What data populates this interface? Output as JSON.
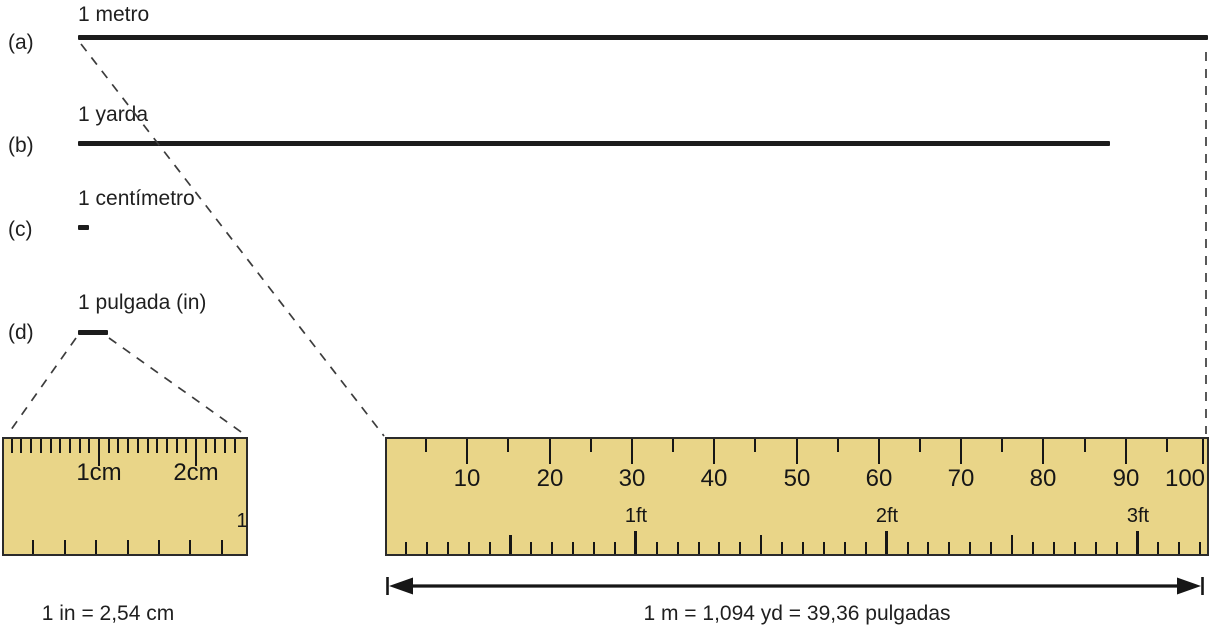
{
  "figure_title": "Comparación de unidades de longitud",
  "colors": {
    "ruler_fill": "#e9d588",
    "ruler_border": "#2b2b2b",
    "bar": "#1c1c1c",
    "tick": "#161616",
    "dash": "#3c3c3c",
    "text": "#1f1f1f"
  },
  "rows": [
    {
      "id": "a",
      "tag": "(a)",
      "name": "1 metro",
      "tag_top": 31,
      "name_top": 3,
      "bar_top": 35,
      "bar_width": 1130
    },
    {
      "id": "b",
      "tag": "(b)",
      "name": "1 yarda",
      "tag_top": 134,
      "name_top": 103,
      "bar_top": 141,
      "bar_width": 1032
    },
    {
      "id": "c",
      "tag": "(c)",
      "name": "1 centímetro",
      "tag_top": 218,
      "name_top": 187,
      "bar_top": 225,
      "bar_width": 11
    },
    {
      "id": "d",
      "tag": "(d)",
      "name": "1 pulgada (in)",
      "tag_top": 321,
      "name_top": 291,
      "bar_top": 330,
      "bar_width": 30
    }
  ],
  "small_ruler": {
    "description": "cm-vs-inch magnified ruler",
    "tick_groups": [
      {
        "name": "mm-tick",
        "side": "top",
        "length": 14,
        "width": 2,
        "positions": [
          9.7,
          19.4,
          29.1,
          38.8,
          48.5,
          58.2,
          67.9,
          77.6,
          87.3,
          106.7,
          116.4,
          126.1,
          135.8,
          145.5,
          155.2,
          164.9,
          174.6,
          184.3,
          203.7,
          213.4,
          223.1,
          232.8
        ]
      },
      {
        "name": "cm-tick",
        "side": "top",
        "length": 27,
        "width": 2.6,
        "positions": [
          97,
          194
        ]
      },
      {
        "name": "eighth-inch-tick",
        "side": "bottom",
        "length": 14,
        "width": 2,
        "positions": [
          31.4,
          62.8,
          94.2,
          125.6,
          157,
          188.4,
          219.8
        ]
      }
    ],
    "labels": [
      {
        "name": "cm-1-label",
        "text": "1cm",
        "x": 97,
        "top": 21,
        "font": 24
      },
      {
        "name": "cm-2-label",
        "text": "2cm",
        "x": 194,
        "top": 21,
        "font": 24
      },
      {
        "name": "inch-1-label",
        "text": "1",
        "x": 240,
        "top": 71,
        "font": 20
      }
    ]
  },
  "large_ruler": {
    "description": "meter stick with cm (top) and inch/ft (bottom) scales",
    "tick_groups": [
      {
        "name": "cm5-tick",
        "side": "top",
        "length": 13,
        "width": 2.2,
        "positions": [
          41,
          123,
          206,
          288,
          370,
          453,
          535,
          617,
          700,
          782
        ]
      },
      {
        "name": "cm10-tick",
        "side": "top",
        "length": 25,
        "width": 2.8,
        "positions": [
          82,
          165,
          247,
          329,
          412,
          494,
          576,
          658,
          741,
          818
        ]
      },
      {
        "name": "inch-tick",
        "side": "bottom",
        "length": 12,
        "width": 2,
        "positions": [
          20.9,
          41.8,
          62.7,
          83.6,
          104.5,
          146.3,
          167.2,
          188.1,
          209,
          229.9,
          271.7,
          292.6,
          313.5,
          334.4,
          355.3,
          397.1,
          418,
          438.9,
          459.8,
          480.7,
          522.5,
          543.4,
          564.3,
          585.2,
          606.1,
          647.9,
          668.8,
          689.7,
          710.6,
          731.5,
          773.3,
          794.2,
          815.1
        ]
      },
      {
        "name": "half-foot-tick",
        "side": "bottom",
        "length": 19,
        "width": 2.6,
        "positions": [
          125.4,
          376.2,
          627
        ]
      },
      {
        "name": "foot-tick",
        "side": "bottom",
        "length": 23,
        "width": 3,
        "positions": [
          250.8,
          501.7,
          752.5
        ]
      }
    ],
    "labels": [
      {
        "name": "cm-number-10",
        "text": "10",
        "x": 82,
        "top": 27,
        "font": 24
      },
      {
        "name": "cm-number-20",
        "text": "20",
        "x": 165,
        "top": 27,
        "font": 24
      },
      {
        "name": "cm-number-30",
        "text": "30",
        "x": 247,
        "top": 27,
        "font": 24
      },
      {
        "name": "cm-number-40",
        "text": "40",
        "x": 329,
        "top": 27,
        "font": 24
      },
      {
        "name": "cm-number-50",
        "text": "50",
        "x": 412,
        "top": 27,
        "font": 24
      },
      {
        "name": "cm-number-60",
        "text": "60",
        "x": 494,
        "top": 27,
        "font": 24
      },
      {
        "name": "cm-number-70",
        "text": "70",
        "x": 576,
        "top": 27,
        "font": 24
      },
      {
        "name": "cm-number-80",
        "text": "80",
        "x": 658,
        "top": 27,
        "font": 24
      },
      {
        "name": "cm-number-90",
        "text": "90",
        "x": 741,
        "top": 27,
        "font": 24
      },
      {
        "name": "cm-number-100",
        "text": "100",
        "x": 800,
        "top": 27,
        "font": 24
      },
      {
        "name": "ft-label-1",
        "text": "1ft",
        "x": 251,
        "top": 66,
        "font": 20
      },
      {
        "name": "ft-label-2",
        "text": "2ft",
        "x": 502,
        "top": 66,
        "font": 20
      },
      {
        "name": "ft-label-3",
        "text": "3ft",
        "x": 753,
        "top": 66,
        "font": 20
      }
    ]
  },
  "equations": {
    "inch_cm": "1 in = 2,54 cm",
    "meter": "1 m = 1,094 yd = 39,36 pulgadas"
  }
}
